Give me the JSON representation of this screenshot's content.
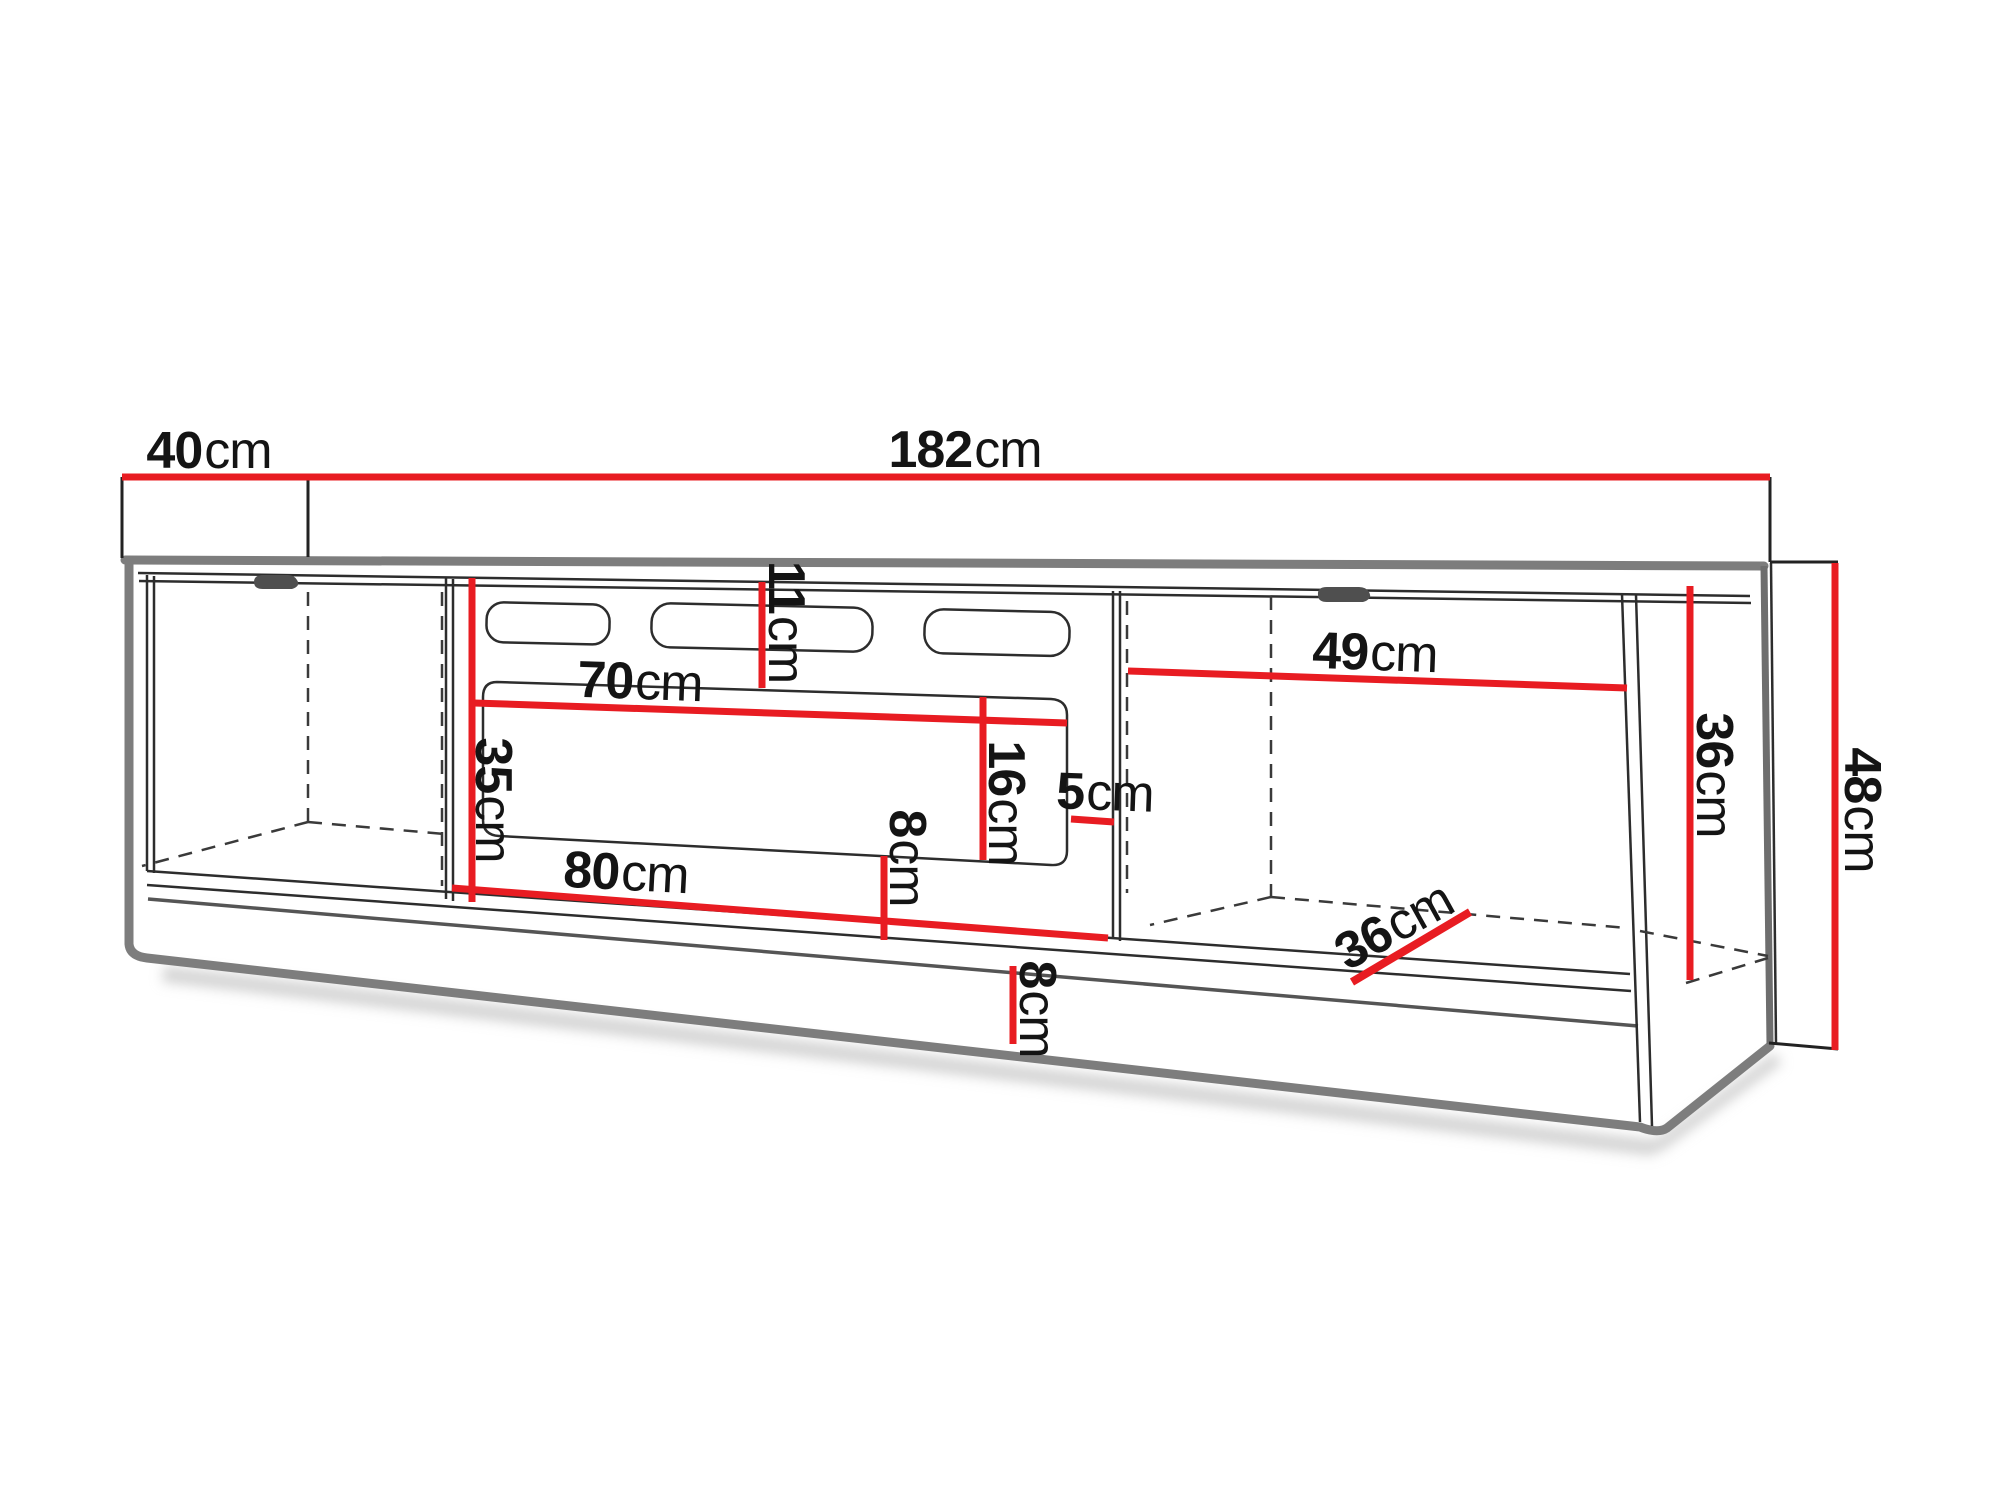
{
  "colors": {
    "dimension_red": "#e81c22",
    "carcass_gray": "#7d7d7d",
    "line_dark": "#2d2d2d",
    "handle_gray": "#4f4f4f",
    "background": "#ffffff"
  },
  "diagram": {
    "type": "furniture-technical-drawing",
    "subject": "TV stand lowboard with left and right closed compartments and open middle media niche, annotated with dimension lines",
    "dims": [
      {
        "id": "total-width",
        "value": "182",
        "unit": "cm"
      },
      {
        "id": "depth",
        "value": "40",
        "unit": "cm"
      },
      {
        "id": "right-compartment-width",
        "value": "49",
        "unit": "cm"
      },
      {
        "id": "niche-top-width",
        "value": "70",
        "unit": "cm"
      },
      {
        "id": "top-clearance",
        "value": "11",
        "unit": "cm"
      },
      {
        "id": "left-interior-height",
        "value": "35",
        "unit": "cm"
      },
      {
        "id": "niche-opening-height",
        "value": "16",
        "unit": "cm"
      },
      {
        "id": "side-clearance",
        "value": "5",
        "unit": "cm"
      },
      {
        "id": "below-niche-clearance",
        "value": "8",
        "unit": "cm"
      },
      {
        "id": "shelf-width",
        "value": "80",
        "unit": "cm"
      },
      {
        "id": "plinth-height",
        "value": "8",
        "unit": "cm"
      },
      {
        "id": "compartment-depth",
        "value": "36",
        "unit": "cm"
      },
      {
        "id": "right-interior-height",
        "value": "36",
        "unit": "cm"
      },
      {
        "id": "total-height",
        "value": "48",
        "unit": "cm"
      }
    ]
  }
}
